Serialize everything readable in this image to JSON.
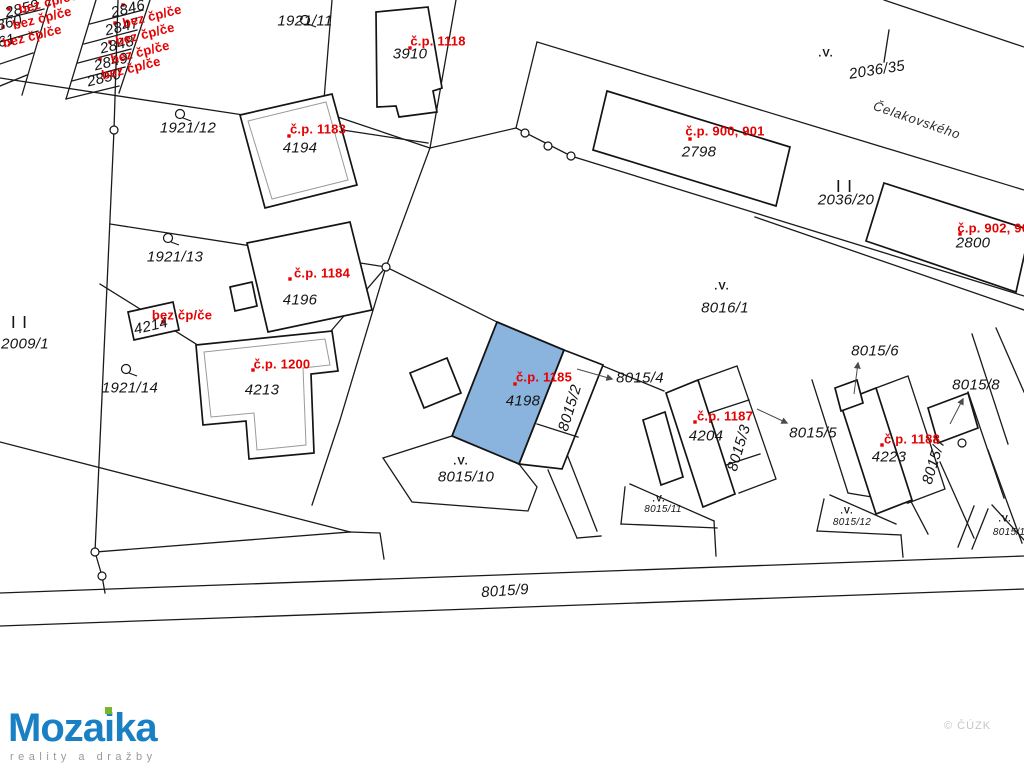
{
  "map": {
    "highlight_color": "#8ab4de",
    "red_color": "#e60000",
    "street_label": {
      "text": "Čelakovského",
      "x": 917,
      "y": 120,
      "rot": 19
    },
    "symbol_v_text": ".V.",
    "symbol_pipes_text": "| |",
    "watermark": "© ČÚZK",
    "parcel_labels": [
      {
        "text": "2846",
        "x": 128,
        "y": 9,
        "rot": -14
      },
      {
        "text": "2847",
        "x": 122,
        "y": 27,
        "rot": -14
      },
      {
        "text": "2848",
        "x": 117,
        "y": 45,
        "rot": -14
      },
      {
        "text": "2849",
        "x": 111,
        "y": 62,
        "rot": -14
      },
      {
        "text": "2850",
        "x": 104,
        "y": 78,
        "rot": -14
      },
      {
        "text": "2859",
        "x": 22,
        "y": 9,
        "rot": -14
      },
      {
        "text": "2860",
        "x": 5,
        "y": 24,
        "rot": -14
      },
      {
        "text": "2861",
        "x": -2,
        "y": 43,
        "rot": -14
      },
      {
        "text": "1921/11",
        "x": 305,
        "y": 21,
        "rot": 0
      },
      {
        "text": "3910",
        "x": 410,
        "y": 54,
        "rot": 0
      },
      {
        "text": "1921/12",
        "x": 188,
        "y": 128,
        "rot": 0
      },
      {
        "text": "4194",
        "x": 300,
        "y": 148,
        "rot": 0
      },
      {
        "text": "1921/13",
        "x": 175,
        "y": 257,
        "rot": 0
      },
      {
        "text": "4196",
        "x": 300,
        "y": 300,
        "rot": 0
      },
      {
        "text": "4214",
        "x": 151,
        "y": 326,
        "rot": -13
      },
      {
        "text": "2009/1",
        "x": 25,
        "y": 344,
        "rot": 0
      },
      {
        "text": "1921/14",
        "x": 130,
        "y": 388,
        "rot": 0
      },
      {
        "text": "4213",
        "x": 262,
        "y": 390,
        "rot": 0
      },
      {
        "text": "4198",
        "x": 523,
        "y": 401,
        "rot": 0
      },
      {
        "text": "8015/2",
        "x": 570,
        "y": 408,
        "rot": -73
      },
      {
        "text": "8015/4",
        "x": 640,
        "y": 378,
        "rot": 0
      },
      {
        "text": "8016/1",
        "x": 725,
        "y": 308,
        "rot": 0
      },
      {
        "text": "2036/35",
        "x": 877,
        "y": 70,
        "rot": -9
      },
      {
        "text": "2036/20",
        "x": 846,
        "y": 200,
        "rot": 0
      },
      {
        "text": "2798",
        "x": 699,
        "y": 152,
        "rot": 0
      },
      {
        "text": "2800",
        "x": 973,
        "y": 243,
        "rot": 0
      },
      {
        "text": "4204",
        "x": 706,
        "y": 436,
        "rot": 0
      },
      {
        "text": "8015/3",
        "x": 739,
        "y": 448,
        "rot": -73
      },
      {
        "text": "8015/5",
        "x": 813,
        "y": 433,
        "rot": 0
      },
      {
        "text": "8015/6",
        "x": 875,
        "y": 351,
        "rot": 0
      },
      {
        "text": "8015/8",
        "x": 976,
        "y": 385,
        "rot": 0
      },
      {
        "text": "4223",
        "x": 889,
        "y": 457,
        "rot": 0
      },
      {
        "text": "8015/7",
        "x": 934,
        "y": 461,
        "rot": -73
      },
      {
        "text": "8015/9",
        "x": 505,
        "y": 591,
        "rot": -4
      },
      {
        "text": "8015/10",
        "x": 466,
        "y": 477,
        "rot": 0
      },
      {
        "text": "8015/11",
        "x": 663,
        "y": 510,
        "rot": 0,
        "size": 10
      },
      {
        "text": "8015/12",
        "x": 852,
        "y": 523,
        "rot": 0,
        "size": 10
      },
      {
        "text": "8015/13",
        "x": 1012,
        "y": 533,
        "rot": 0,
        "size": 10
      }
    ],
    "red_labels": [
      {
        "text": "bez čp/če",
        "x": 48,
        "y": 2,
        "rot": -14
      },
      {
        "text": "bez čp/če",
        "x": 42,
        "y": 18,
        "rot": -14
      },
      {
        "text": "bez čp/če",
        "x": 32,
        "y": 36,
        "rot": -14
      },
      {
        "text": "bez čp/če",
        "x": 152,
        "y": 16,
        "rot": -14
      },
      {
        "text": "bez čp/če",
        "x": 145,
        "y": 34,
        "rot": -14
      },
      {
        "text": "bez čp/če",
        "x": 140,
        "y": 52,
        "rot": -14
      },
      {
        "text": "bez čp/če",
        "x": 131,
        "y": 68,
        "rot": -14
      },
      {
        "text": "bez čp/če",
        "x": 182,
        "y": 315,
        "rot": 0
      },
      {
        "text": "č.p. 1118",
        "x": 438,
        "y": 41,
        "rot": 0
      },
      {
        "text": "č.p. 1183",
        "x": 318,
        "y": 129,
        "rot": 0
      },
      {
        "text": "č.p. 1184",
        "x": 322,
        "y": 273,
        "rot": 0
      },
      {
        "text": "č.p. 1200",
        "x": 282,
        "y": 364,
        "rot": 0
      },
      {
        "text": "č.p. 1185",
        "x": 544,
        "y": 377,
        "rot": 0
      },
      {
        "text": "č.p. 1187",
        "x": 725,
        "y": 416,
        "rot": 0
      },
      {
        "text": "č.p. 1188",
        "x": 912,
        "y": 439,
        "rot": 0
      },
      {
        "text": "č.p. 900, 901",
        "x": 725,
        "y": 131,
        "rot": 0
      },
      {
        "text": "č.p. 902, 903",
        "x": 997,
        "y": 228,
        "rot": 0
      }
    ],
    "v_symbols": [
      {
        "x": 826,
        "y": 54
      },
      {
        "x": 722,
        "y": 287
      },
      {
        "x": 461,
        "y": 462
      },
      {
        "x": 659,
        "y": 499,
        "size": 9
      },
      {
        "x": 847,
        "y": 511,
        "size": 9
      },
      {
        "x": 1005,
        "y": 519,
        "size": 9
      }
    ],
    "pipe_symbols": [
      {
        "x": 20,
        "y": 321
      },
      {
        "x": 845,
        "y": 185
      }
    ],
    "red_dots": [
      [
        123,
        5
      ],
      [
        115,
        23
      ],
      [
        110,
        42
      ],
      [
        100,
        59
      ],
      [
        9,
        9
      ],
      [
        3,
        27
      ],
      [
        163,
        322
      ],
      [
        410,
        48
      ],
      [
        289,
        136
      ],
      [
        290,
        279
      ],
      [
        253,
        370
      ],
      [
        515,
        384
      ],
      [
        695,
        422
      ],
      [
        882,
        445
      ],
      [
        690,
        139
      ],
      [
        960,
        234
      ]
    ],
    "boundary_markers": [
      [
        114,
        130
      ],
      [
        95,
        552
      ],
      [
        102,
        576
      ],
      [
        525,
        133
      ],
      [
        548,
        146
      ],
      [
        571,
        156
      ],
      [
        962,
        443
      ],
      [
        386,
        267
      ]
    ],
    "garden_symbols": [
      [
        305,
        20
      ],
      [
        180,
        114
      ],
      [
        168,
        238
      ],
      [
        126,
        369
      ]
    ],
    "arrows": [
      [
        577,
        369,
        612,
        379
      ],
      [
        757,
        409,
        787,
        423
      ],
      [
        854,
        394,
        858,
        363
      ],
      [
        950,
        424,
        963,
        399
      ]
    ]
  },
  "logo": {
    "part1": "Moza",
    "part2": "i",
    "part3": "ka",
    "tagline": "reality a dražby",
    "blue": "#1a80c4",
    "green": "#76b82a",
    "gray": "#9a9a9a"
  }
}
